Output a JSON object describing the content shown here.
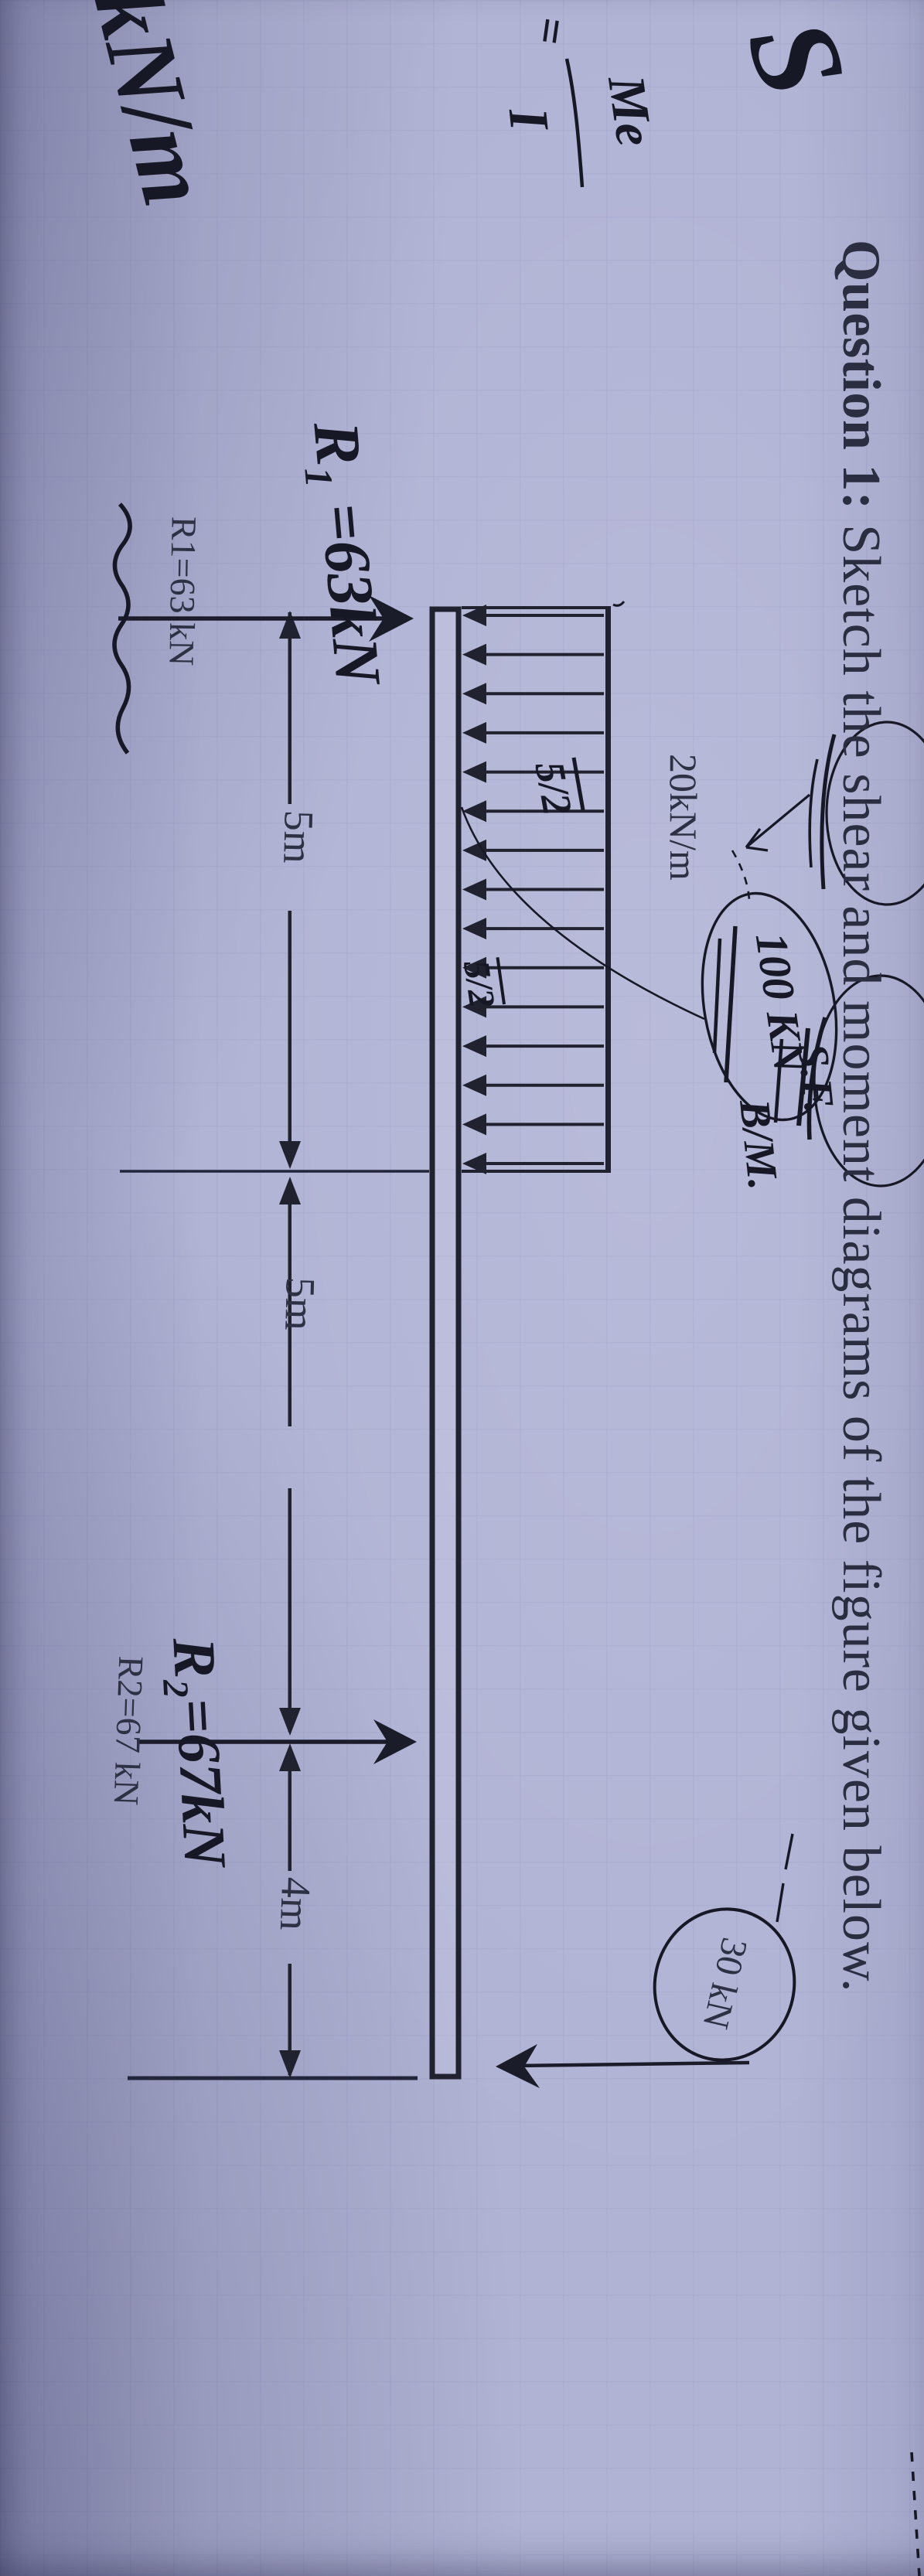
{
  "page": {
    "paper_color": "#b1b3d5",
    "ink_color": "#171826",
    "print_color": "#2e3044"
  },
  "title": {
    "label_bold": "Question 1:",
    "label_rest": " Sketch the shear and moment diagrams of the figure given below."
  },
  "figure": {
    "distributed_load": {
      "label": "20kN/m",
      "arrow_count": 15
    },
    "dimensions": {
      "seg1": "5m",
      "seg2": "5m",
      "seg3": "4m"
    },
    "point_load": {
      "label": "30 kN"
    },
    "reactions": {
      "r1_printed": "R1=63 kN",
      "r2_printed": "R2=67 kN"
    }
  },
  "handwriting": {
    "formula": {
      "sigma": "S",
      "equals": "=",
      "numerator": "Me",
      "denominator": "I"
    },
    "resultant": "100 KN",
    "shear_note": "S.F.",
    "moment_note": "B/M.",
    "r1": "R₁ =63kN",
    "r2": "R₂=67kN",
    "half1": "5/2",
    "half2": "5/2",
    "corner": "kN/m"
  }
}
